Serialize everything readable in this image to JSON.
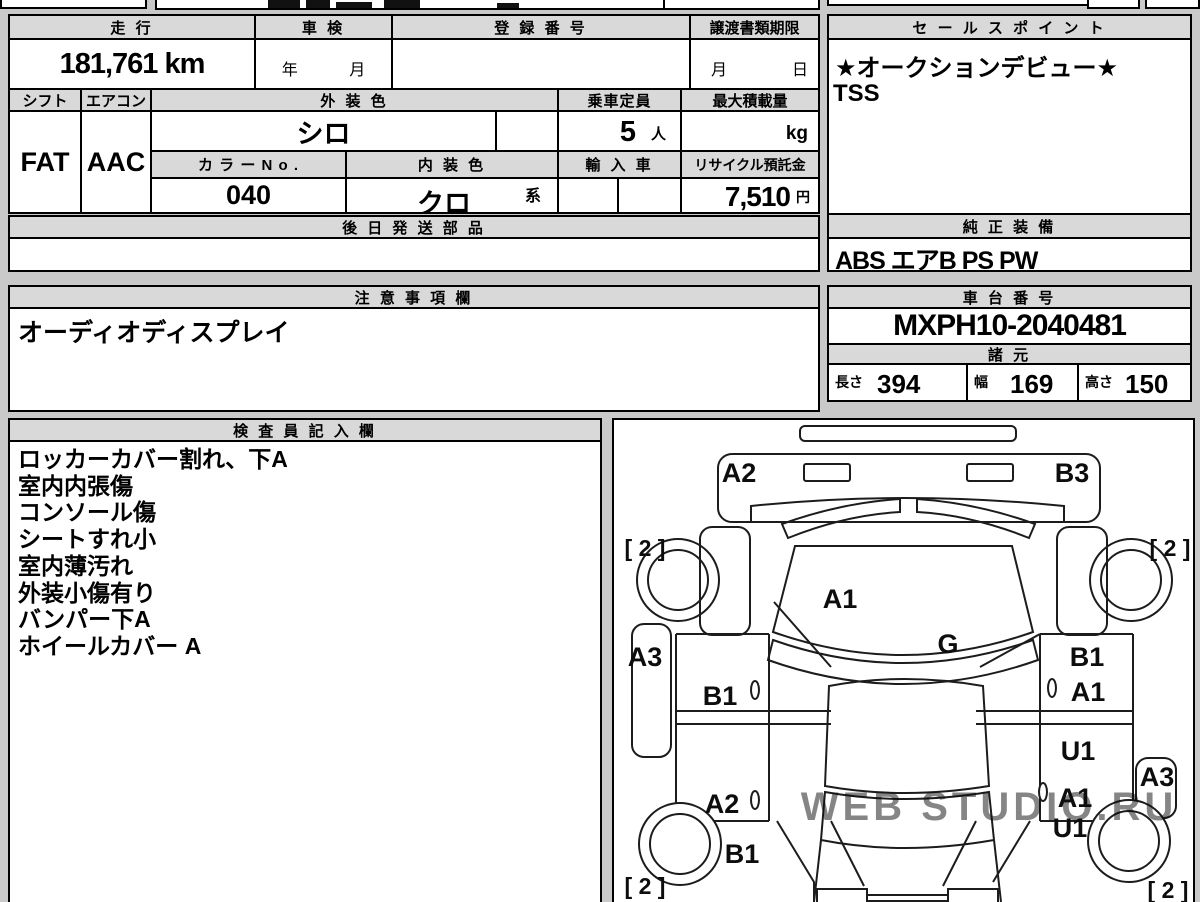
{
  "info": {
    "mileage_label": "走 行",
    "mileage_value": "181,761 km",
    "shaken_label": "車 検",
    "shaken_year": "年",
    "shaken_month": "月",
    "registration_label": "登 録 番 号",
    "registration_value": "",
    "deadline_label": "譲渡書類期限",
    "deadline_month": "月",
    "deadline_day": "日",
    "shift_label": "シフト",
    "shift_value": "FAT",
    "aircon_label": "エアコン",
    "aircon_value": "AAC",
    "exterior_color_label": "外 装 色",
    "exterior_color_value": "シロ",
    "capacity_label": "乗車定員",
    "capacity_value": "5",
    "capacity_unit": "人",
    "max_load_label": "最大積載量",
    "max_load_value": "",
    "max_load_unit": "kg",
    "color_no_label": "カ ラ ー N o .",
    "color_no_value": "040",
    "interior_color_label": "内 装 色",
    "interior_color_value": "クロ",
    "interior_color_suffix": "系",
    "import_label": "輸 入 車",
    "recycle_label": "リサイクル預託金",
    "recycle_value": "7,510",
    "recycle_unit": "円",
    "later_parts_label": "後 日 発 送 部 品",
    "later_parts_value": ""
  },
  "sales_point": {
    "label": "セ ー ル ス ポ イ ン ト",
    "line1": "★オークションデビュー★",
    "line2": "TSS"
  },
  "equipment": {
    "label": "純 正 装 備",
    "value": "ABS エアB PS PW"
  },
  "notes": {
    "label": "注 意 事 項 欄",
    "value": "オーディオディスプレイ"
  },
  "chassis": {
    "label": "車 台 番 号",
    "value": "MXPH10-2040481"
  },
  "specs": {
    "label": "諸 元",
    "length_label": "長さ",
    "length_value": "394",
    "width_label": "幅",
    "width_value": "169",
    "height_label": "高さ",
    "height_value": "150"
  },
  "inspector": {
    "label": "検 査 員 記 入 欄",
    "lines": [
      "ロッカーカバー割れ、下A",
      "室内内張傷",
      "コンソール傷",
      "シートすれ小",
      "室内薄汚れ",
      "外装小傷有り",
      "バンパー下A",
      "ホイールカバー A"
    ]
  },
  "diagram": {
    "damage_labels": [
      "A2",
      "B3",
      "[ 2 ]",
      "[ 2 ]",
      "A1",
      "A3",
      "G",
      "B1",
      "B1",
      "A1",
      "U1",
      "A2",
      "A1",
      "A3",
      "B1",
      "U1",
      "[ 2 ]",
      "[ 2 ]"
    ],
    "watermark": "WEB STUDIO.RU"
  }
}
